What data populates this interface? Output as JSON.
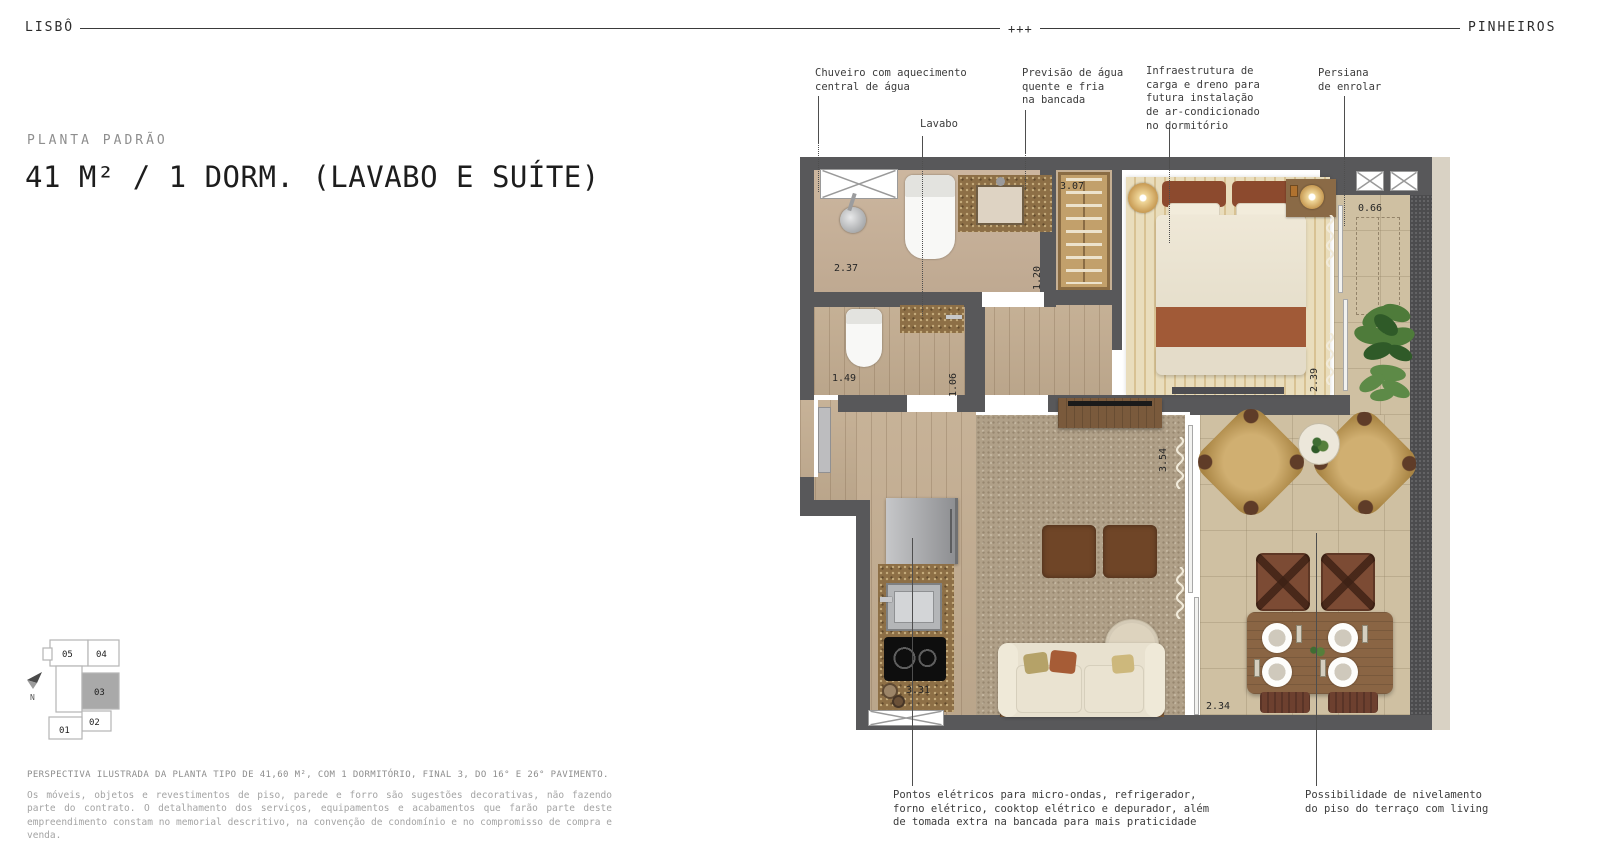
{
  "header": {
    "brand_left": "LISBÔ",
    "center_mark": "+++",
    "brand_right": "PINHEIROS"
  },
  "title": {
    "eyebrow": "PLANTA PADRÃO",
    "main": "41 M² / 1 DORM. (LAVABO E SUÍTE)"
  },
  "callouts": {
    "chuveiro": "Chuveiro com aquecimento\ncentral de água",
    "lavabo": "Lavabo",
    "previsao": "Previsão de água\nquente e fria\nna bancada",
    "infraestrutura": "Infraestrutura de\ncarga e dreno para\nfutura instalação\nde ar-condicionado\nno dormitório",
    "persiana": "Persiana\nde enrolar",
    "pontos_eletricos": "Pontos elétricos para micro-ondas, refrigerador,\nforno elétrico, cooktop elétrico e depurador, além\nde tomada extra na bancada para mais praticidade",
    "nivelamento": "Possibilidade de nivelamento\ndo piso do terraço com living"
  },
  "plan": {
    "measurements": {
      "suite_bath": "2.37",
      "lavabo_width": "1.49",
      "lavabo_depth": "1.06",
      "hall_width": "1.20",
      "closet_width": "3.07",
      "bedroom_width": "2.39",
      "terrace_depth": "0.66",
      "living_width": "3.54",
      "kitchen_width": "3.31",
      "terrace_width": "2.34"
    }
  },
  "keyplan": {
    "units": [
      "05",
      "04",
      "03",
      "02",
      "01"
    ],
    "highlighted_unit": "03",
    "compass": "N"
  },
  "footer": {
    "caption": "PERSPECTIVA ILUSTRADA DA PLANTA TIPO DE 41,60 M², COM 1 DORMITÓRIO, FINAL 3, DO 16° E 26° PAVIMENTO.",
    "disclaimer": "Os móveis, objetos e revestimentos de piso, parede e forro são sugestões decorativas, não fazendo parte do contrato. O detalhamento dos serviços, equipamentos e acabamentos que farão parte deste empreendimento constam no memorial descritivo, na convenção de condomínio e no compromisso de compra e venda."
  },
  "palette": {
    "wall": "#58585a",
    "wood": "#c4ae92",
    "tile": "#cfc0a2",
    "carpet": "#b0a088",
    "terracotta": "#a15a37",
    "granite": "#8d6f46",
    "keyplan_highlight": "#a9a9a9"
  }
}
